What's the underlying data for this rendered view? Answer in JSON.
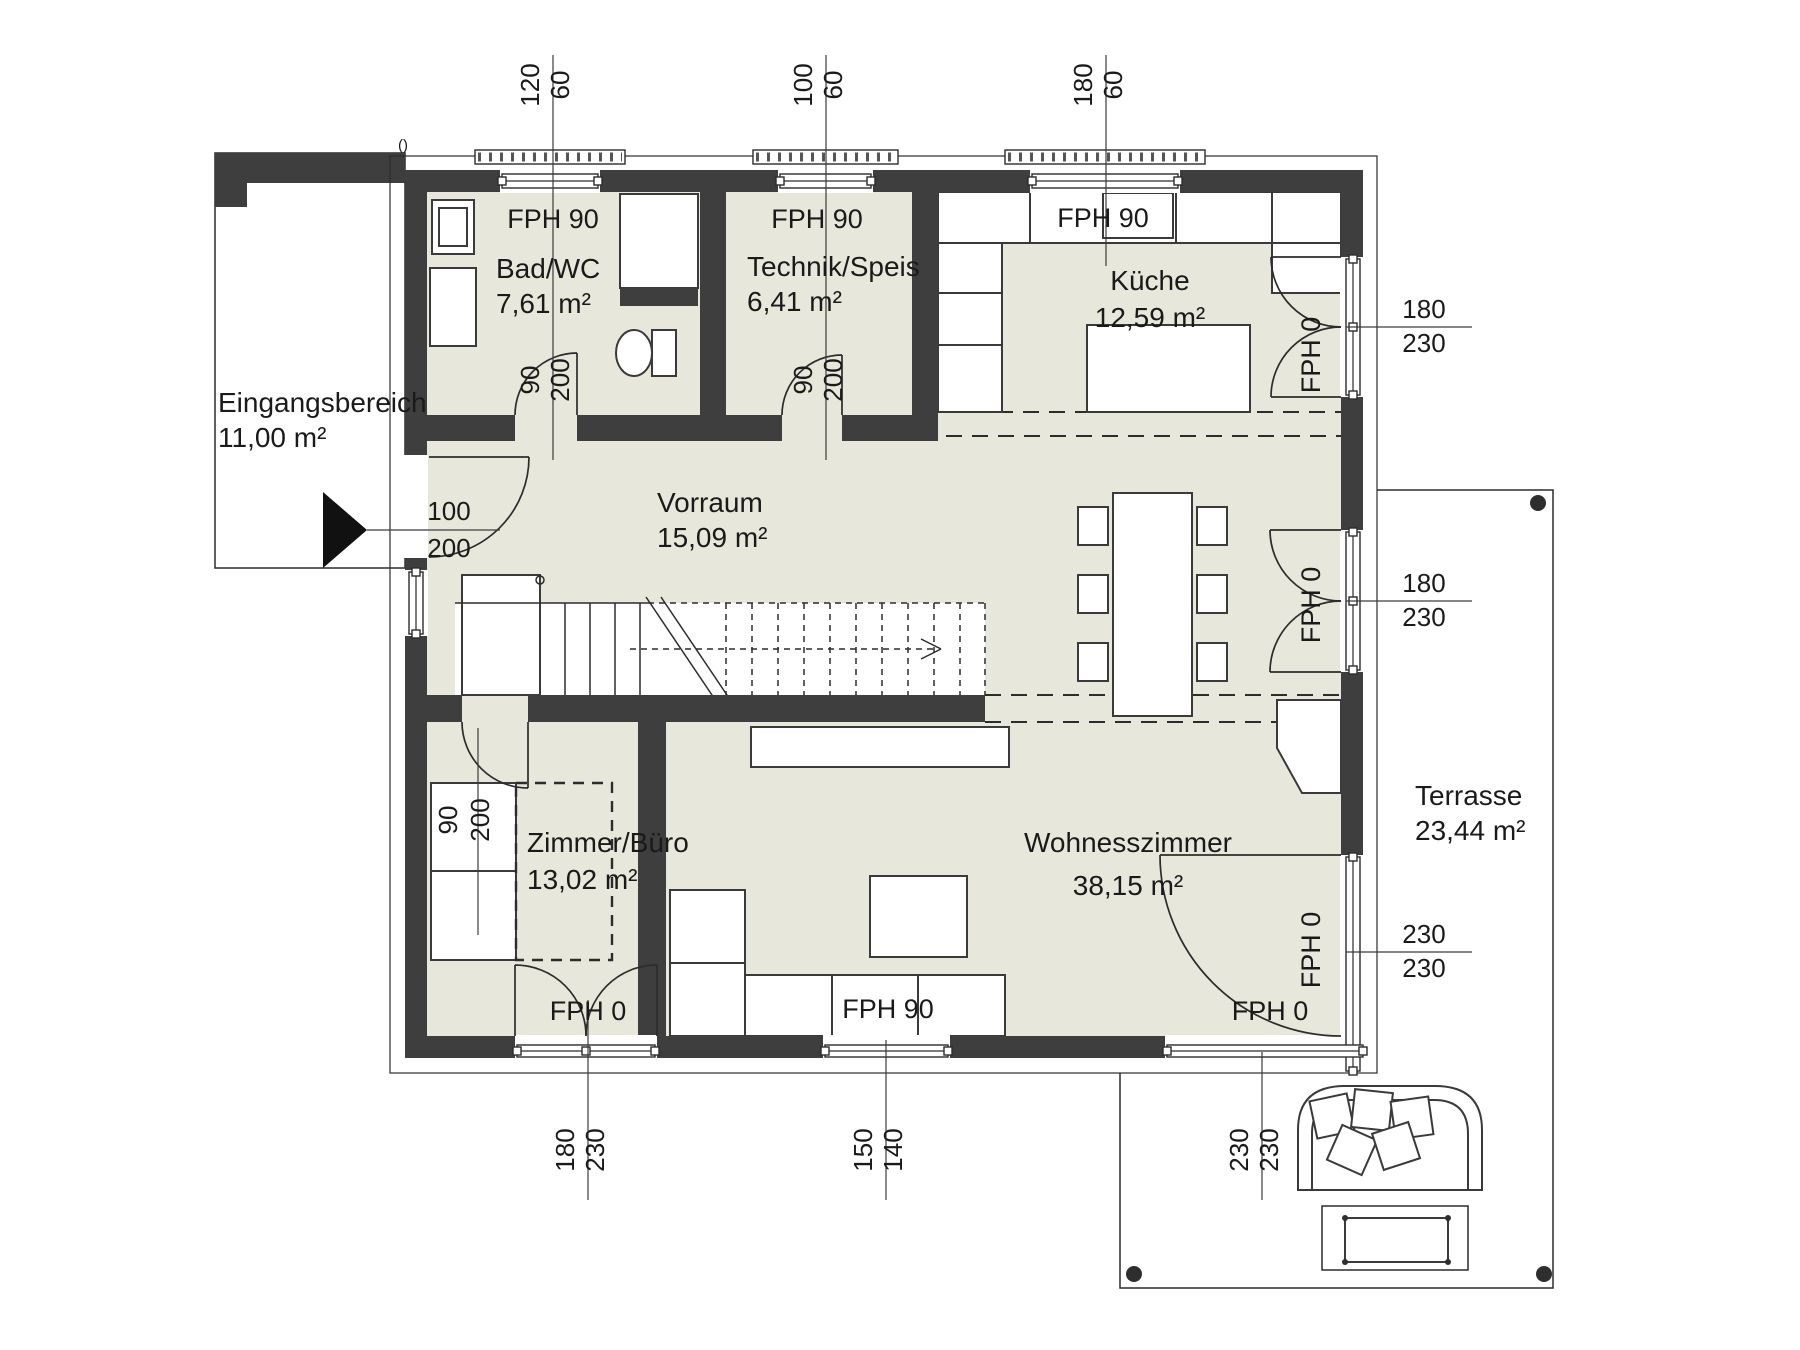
{
  "rooms": {
    "eingangsbereich": {
      "name": "Eingangsbereich",
      "area": "11,00 m²"
    },
    "bad": {
      "name": "Bad/WC",
      "area": "7,61 m²"
    },
    "technik": {
      "name": "Technik/Speis",
      "area": "6,41 m²"
    },
    "kueche": {
      "name": "Küche",
      "area": "12,59 m²"
    },
    "vorraum": {
      "name": "Vorraum",
      "area": "15,09 m²"
    },
    "zimmer": {
      "name": "Zimmer/Büro",
      "area": "13,02 m²"
    },
    "wohnzimmer": {
      "name": "Wohnesszimmer",
      "area": "38,15 m²"
    },
    "terrasse": {
      "name": "Terrasse",
      "area": "23,44 m²"
    }
  },
  "exterior_openings": {
    "top": [
      {
        "label": "FPH 90",
        "width": "120",
        "height": "60"
      },
      {
        "label": "FPH 90",
        "width": "100",
        "height": "60"
      },
      {
        "label": "FPH 90",
        "width": "180",
        "height": "60"
      }
    ],
    "right": [
      {
        "label": "FPH 0",
        "width": "180",
        "height": "230"
      },
      {
        "label": "FPH 0",
        "width": "180",
        "height": "230"
      },
      {
        "label": "FPH 0",
        "width": "230",
        "height": "230"
      }
    ],
    "bottom": [
      {
        "label": "FPH 0",
        "width": "180",
        "height": "230"
      },
      {
        "label": "FPH 90",
        "width": "150",
        "height": "140"
      },
      {
        "label": "FPH 0",
        "width": "230",
        "height": "230"
      }
    ]
  },
  "interior_doors": {
    "entry": {
      "width": "100",
      "height": "200"
    },
    "bad": {
      "width": "90",
      "height": "200"
    },
    "technik": {
      "width": "90",
      "height": "200"
    },
    "zimmer": {
      "width": "90",
      "height": "200"
    }
  },
  "misc": {
    "corner_mark": "()"
  },
  "colors": {
    "wall": "#3e3e3e",
    "floor": "#e8e7db",
    "line": "#2c2c2c"
  }
}
